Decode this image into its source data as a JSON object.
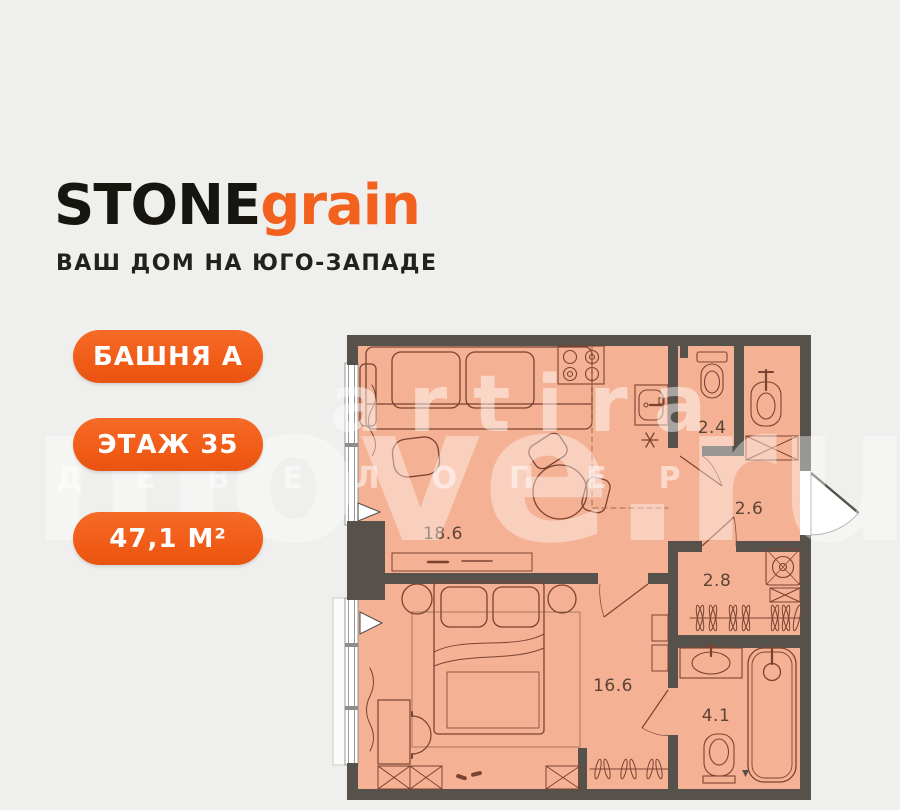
{
  "brand": {
    "name_primary": "STONE",
    "name_secondary": "grain",
    "tagline": "ВАШ ДОМ НА ЮГО-ЗАПАДЕ"
  },
  "badges": [
    {
      "label": "БАШНЯ А"
    },
    {
      "label": "ЭТАЖ 35"
    },
    {
      "label": "47,1 М²"
    }
  ],
  "plan": {
    "rooms": [
      {
        "name": "living-kitchen",
        "area": "18.6"
      },
      {
        "name": "wc",
        "area": "2.4"
      },
      {
        "name": "hallway",
        "area": "2.6"
      },
      {
        "name": "corridor",
        "area": "2.8"
      },
      {
        "name": "bedroom",
        "area": "16.6"
      },
      {
        "name": "bathroom",
        "area": "4.1"
      }
    ]
  },
  "watermark": {
    "line1": "artira",
    "line2": "move.ru",
    "line3": "ДЕВЕЛОПЕР"
  },
  "colors": {
    "accent_orange": "#F2611D",
    "wall": "#56514B",
    "room_fill": "#F5B193",
    "plan_line": "#7A4331",
    "background": "#EFEFEE"
  }
}
